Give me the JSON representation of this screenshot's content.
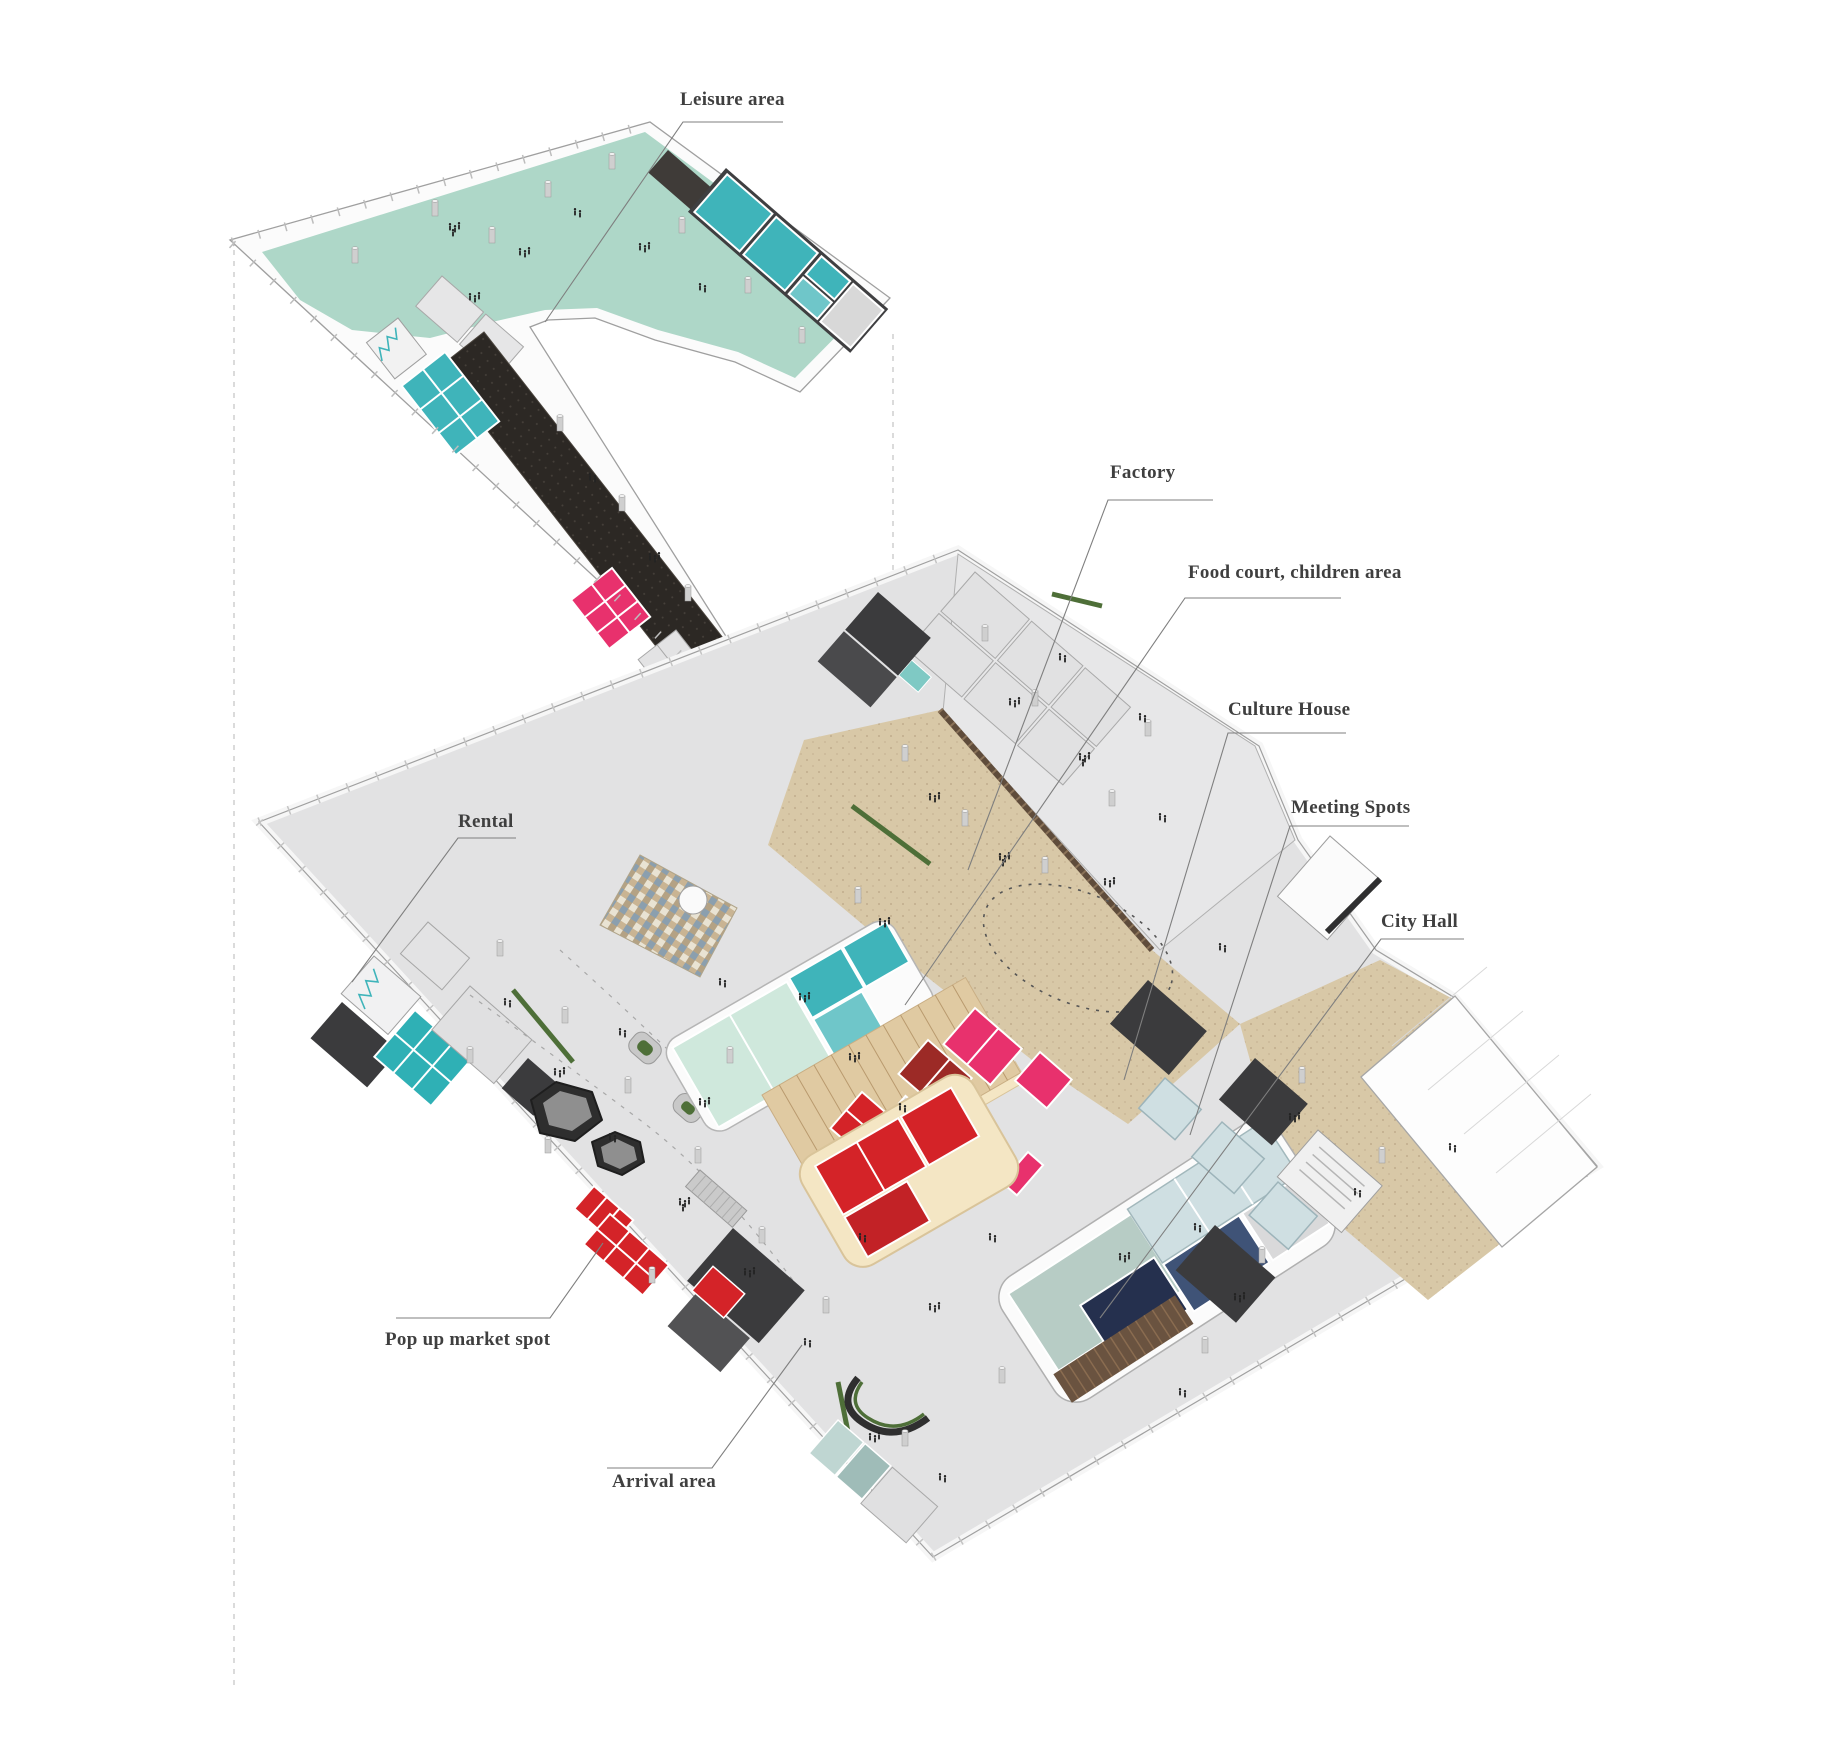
{
  "page": {
    "title": "Exploded axonometric floor plan diagram"
  },
  "diagram": {
    "type": "exploded-axonometric-floor-plan",
    "floors": [
      {
        "id": "upper",
        "name": "Upper floor (leisure level)"
      },
      {
        "id": "ground",
        "name": "Ground floor (public level)"
      }
    ],
    "annotations": [
      {
        "id": "leisure-area",
        "text": "Leisure area"
      },
      {
        "id": "factory",
        "text": "Factory"
      },
      {
        "id": "food-court",
        "text": "Food court,  children area"
      },
      {
        "id": "culture-house",
        "text": "Culture House"
      },
      {
        "id": "meeting-spots",
        "text": "Meeting Spots"
      },
      {
        "id": "city-hall",
        "text": "City Hall"
      },
      {
        "id": "rental",
        "text": "Rental"
      },
      {
        "id": "pop-up-market",
        "text": "Pop up market spot"
      },
      {
        "id": "arrival-area",
        "text": "Arrival area"
      }
    ],
    "colors": {
      "mint": "#aed7c8",
      "teal": "#3fb4ba",
      "teal_light": "#cfe8dc",
      "charcoal_floor": "#2c2824",
      "magenta": "#e8316d",
      "red": "#d42328",
      "dark_red": "#9c2a26",
      "cream": "#f4e6c4",
      "wood_steps": "#e0caa2",
      "beige_floor": "#d8c8a7",
      "sage": "#b7ccc5",
      "navy": "#25304e",
      "wood_slat": "#6a5340",
      "glass": "#cfdfe2",
      "slate_blue": "#3f5377",
      "dark_room": "#3b3b3d",
      "green": "#4e6f38",
      "plate_floor": "#e2e2e3",
      "wall_white": "#fbfbfb",
      "pond_ring": "#2e2e2e",
      "pond_fill": "#8f8f8f",
      "column": "#cfcfcf",
      "label_text": "#3f3f3f",
      "leader": "#7f7f7f"
    }
  }
}
